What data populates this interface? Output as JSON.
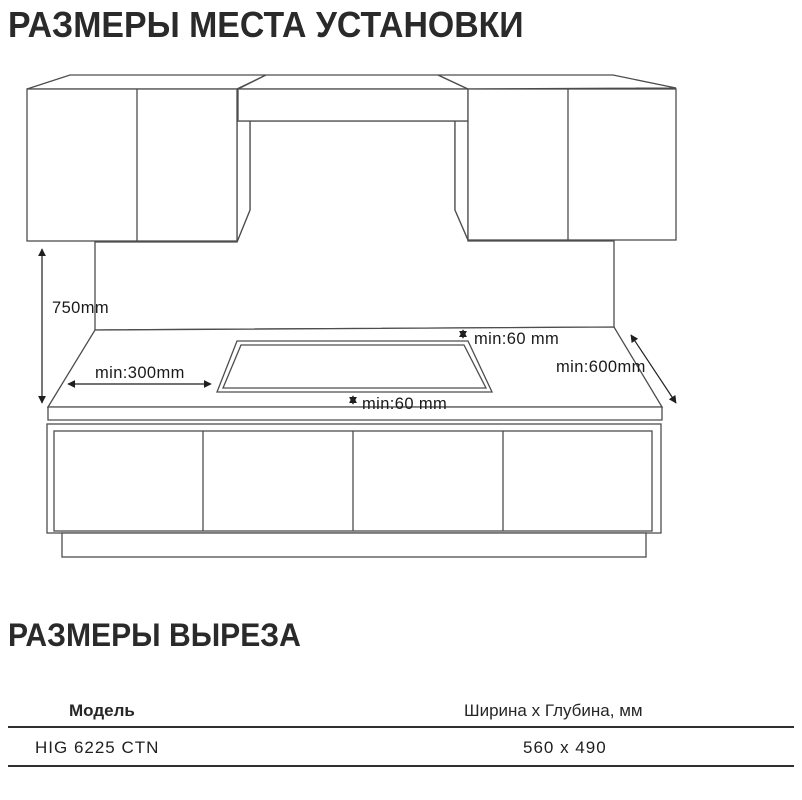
{
  "install_section": {
    "title": "РАЗМЕРЫ МЕСТА УСТАНОВКИ",
    "dimensions": {
      "wall_height": "750mm",
      "left_clearance": "min:300mm",
      "back_clearance": "min:60 mm",
      "worktop_depth": "min:600mm",
      "front_clearance": "min:60 mm"
    },
    "colors": {
      "wall": "#e9e9eb",
      "hob": "#a9a9ab"
    }
  },
  "cutout_section": {
    "title": "РАЗМЕРЫ ВЫРЕЗА",
    "table": {
      "col_model": "Модель",
      "col_size": "Ширина x Глубина, мм",
      "rows": [
        {
          "model": "HIG 6225 CTN",
          "size": "560 x 490"
        }
      ]
    }
  }
}
